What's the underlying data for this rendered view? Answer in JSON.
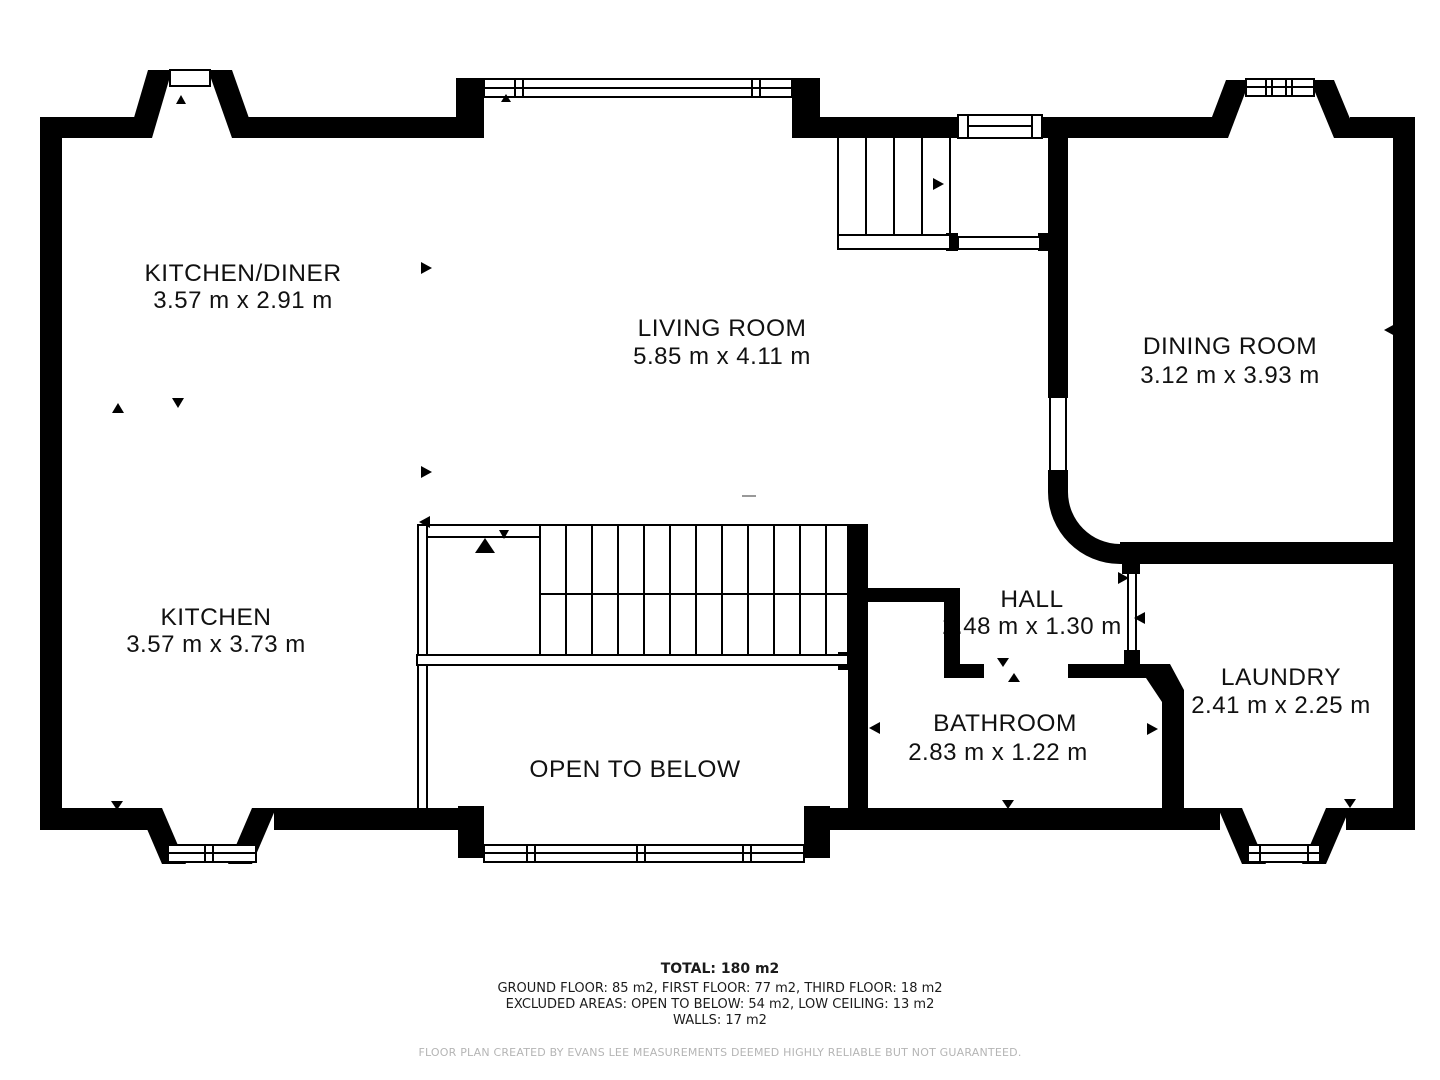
{
  "rooms": {
    "kitchen_diner": {
      "name": "KITCHEN/DINER",
      "dims": "3.57 m x 2.91 m"
    },
    "living_room": {
      "name": "LIVING ROOM",
      "dims": "5.85 m x 4.11 m"
    },
    "dining_room": {
      "name": "DINING ROOM",
      "dims": "3.12 m x 3.93 m"
    },
    "kitchen": {
      "name": "KITCHEN",
      "dims": "3.57 m x 3.73 m"
    },
    "hall": {
      "name": "HALL",
      "dims": "2.48 m x 1.30 m"
    },
    "laundry": {
      "name": "LAUNDRY",
      "dims": "2.41 m x 2.25 m"
    },
    "bathroom": {
      "name": "BATHROOM",
      "dims": "2.83 m x 1.22 m"
    },
    "open_to_below": {
      "name": "OPEN TO BELOW"
    }
  },
  "footer": {
    "total": "TOTAL: 180 m2",
    "floors": "GROUND FLOOR: 85 m2, FIRST FLOOR: 77 m2, THIRD FLOOR: 18 m2",
    "excluded": "EXCLUDED AREAS: OPEN TO BELOW: 54 m2, LOW CEILING: 13 m2",
    "walls": "WALLS: 17 m2",
    "disclaimer": "FLOOR PLAN CREATED BY EVANS LEE MEASUREMENTS DEEMED HIGHLY RELIABLE BUT NOT GUARANTEED."
  },
  "colors": {
    "wall": "#000000",
    "text": "#111111",
    "disclaimer": "#b5b5b5"
  }
}
